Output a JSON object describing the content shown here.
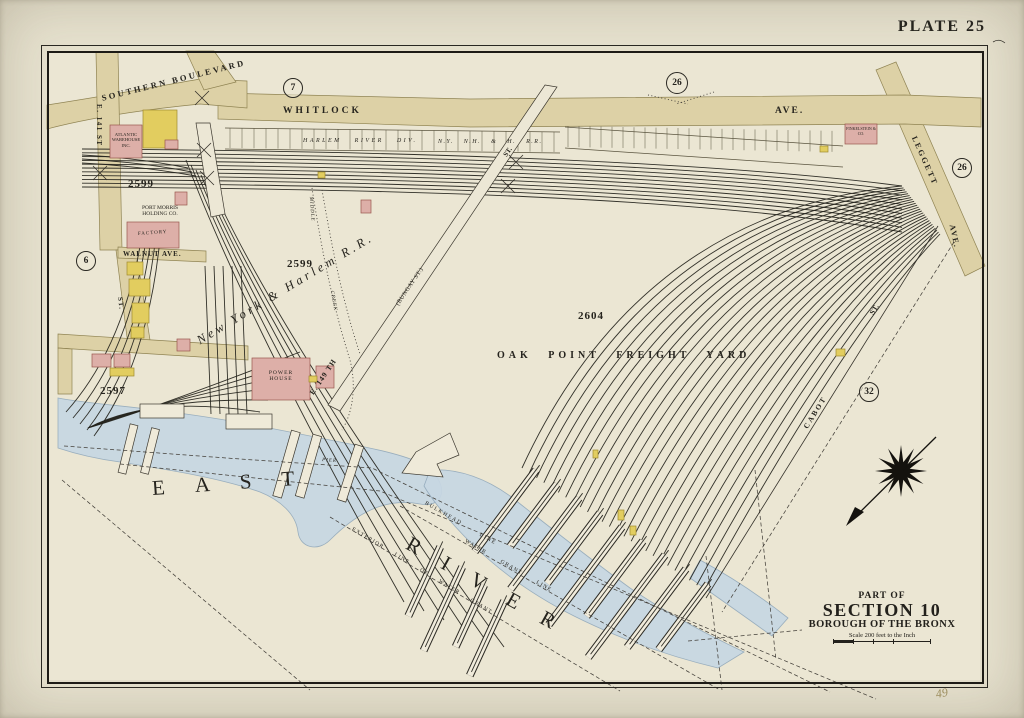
{
  "page": {
    "plate": "PLATE 25",
    "pencil_note": "49"
  },
  "title_block": {
    "part_of": "PART OF",
    "section": "SECTION 10",
    "borough": "BOROUGH OF THE BRONX",
    "scale": "Scale 200 feet to the Inch"
  },
  "badges": {
    "c7": "7",
    "c26_top": "26",
    "c26_right": "26",
    "c6": "6",
    "c32": "32"
  },
  "streets": {
    "southern_boulevard": "SOUTHERN BOULEVARD",
    "whitlock": "WHITLOCK",
    "whitlock_ave": "AVE.",
    "e141st": "E. 141 ST",
    "st_lower": "ST.",
    "walnut": "WALNUT AVE.",
    "leggett": "LEGGETT",
    "leggett_ave": "AVE.",
    "e149th": "E. 149 TH",
    "bungay": "(BUNGAY ST.)",
    "e149_st": "ST.",
    "cabot": "CABOT",
    "cabot_st": "ST."
  },
  "railroads": {
    "harlem_river_div": "HARLEM RIVER DIV.",
    "nynh_rr": "N.Y. N.H. & H. R.R.",
    "ny_harlem_rr": "New York & Harlem R.R."
  },
  "features": {
    "oak_point_yard": "OAK POINT FREIGHT YARD",
    "east": "EAST",
    "river": "RIVER",
    "middle": "MIDDLE",
    "creek": "CREEK",
    "pier": "PIER"
  },
  "harbor_lines": {
    "bulkhead": "BULKHEAD LINE",
    "water_grant": "WATER GRANT LINE",
    "exterior": "EXTERIOR LINE OF WATER GRANT"
  },
  "buildings": {
    "atlantic_warehouse": "ATLANTIC WAREHOUSE INC.",
    "port_morris": "PORT MORRIS HOLDING CO.",
    "factory": "FACTORY",
    "power_house": "POWER HOUSE",
    "finkelstein": "FINKELSTEIN & CO."
  },
  "block_numbers": {
    "b2599_west": "2599",
    "b2599_mid": "2599",
    "b2604": "2604",
    "b2597": "2597"
  },
  "colors": {
    "paper": "#eae5d1",
    "street_tan": "#ddd1a6",
    "building_pink": "#ddafa8",
    "building_yellow": "#e2cd5f",
    "water_blue": "#c7d7e3",
    "ink": "#23211c"
  }
}
